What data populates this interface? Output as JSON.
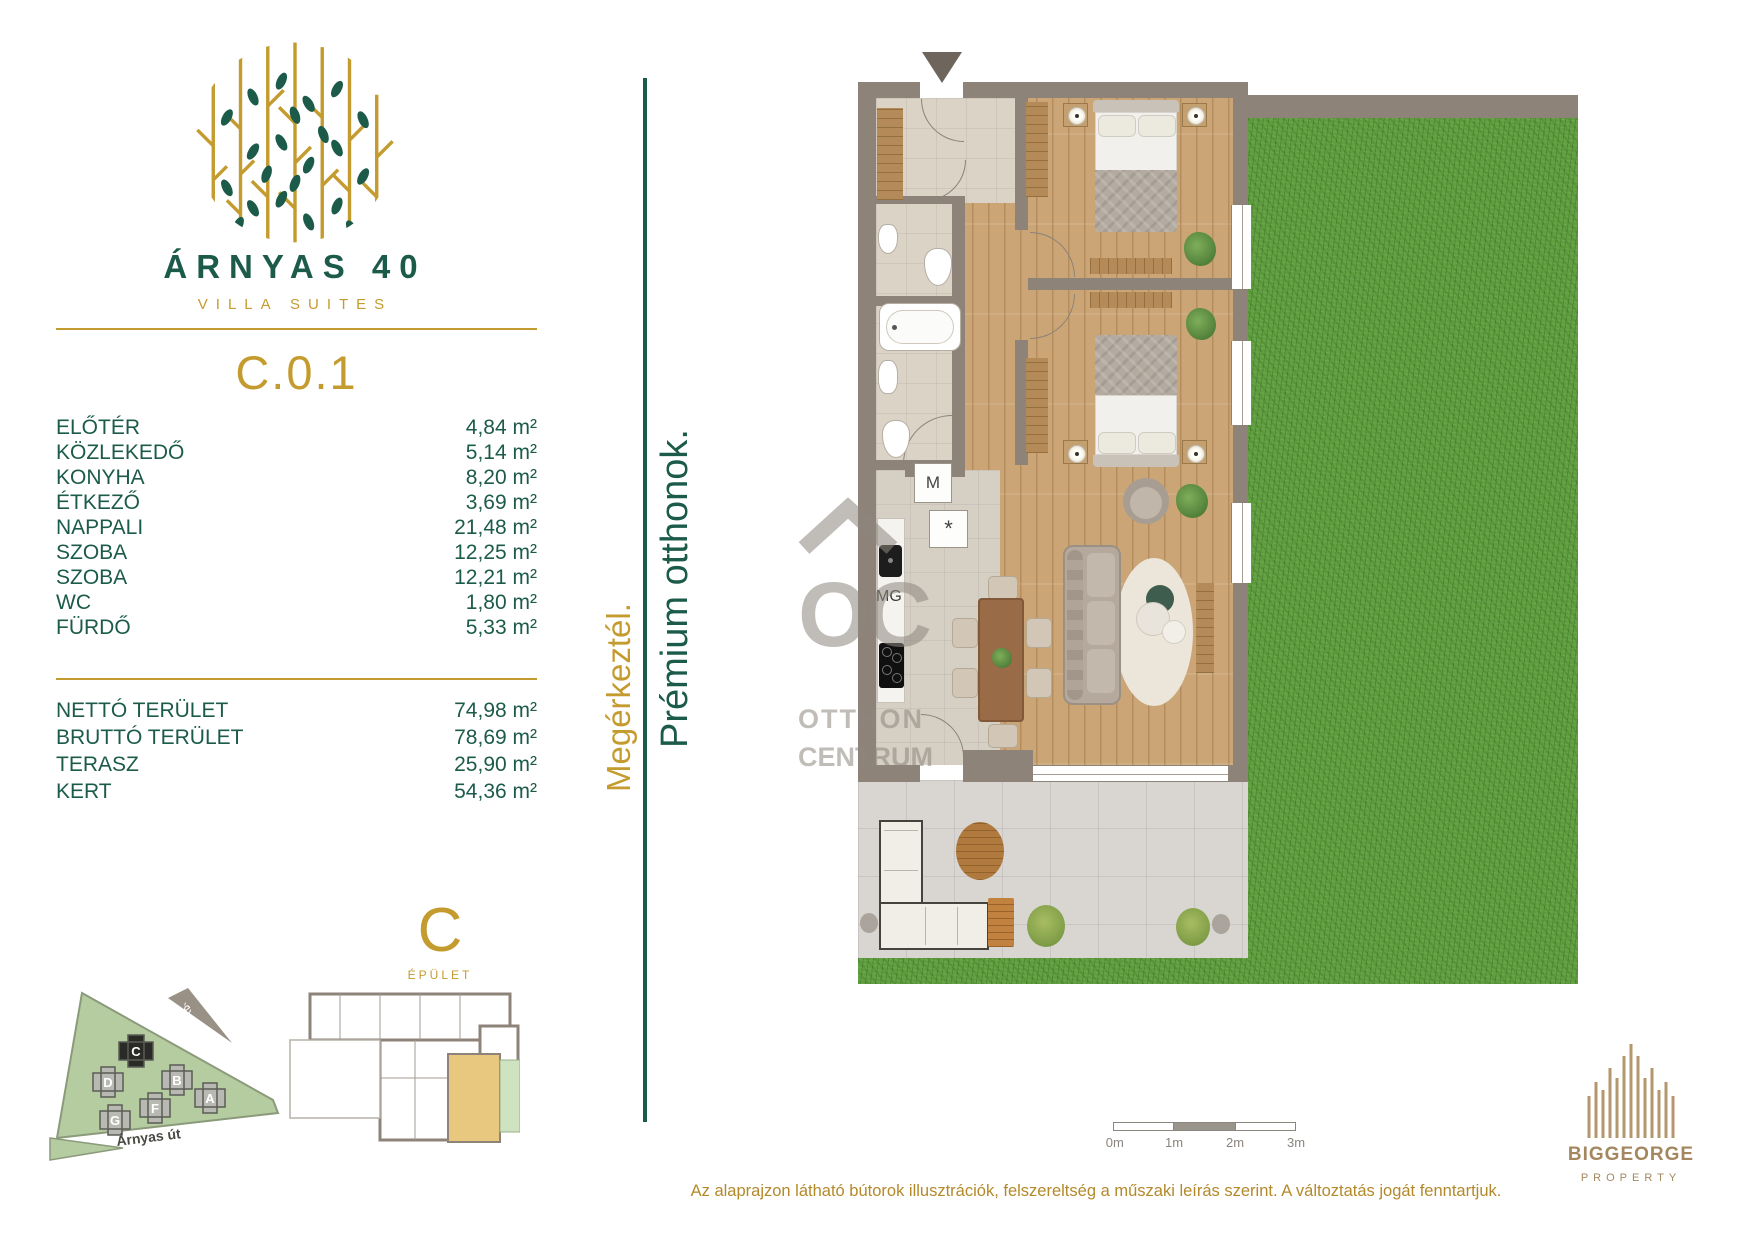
{
  "brand": {
    "title": "ÁRNYAS 40",
    "subtitle": "VILLA SUITES"
  },
  "unit": {
    "code": "C.0.1"
  },
  "rooms": [
    {
      "name": "ELŐTÉR",
      "area": "4,84 m²"
    },
    {
      "name": "KÖZLEKEDŐ",
      "area": "5,14 m²"
    },
    {
      "name": "KONYHA",
      "area": "8,20 m²"
    },
    {
      "name": "ÉTKEZŐ",
      "area": "3,69 m²"
    },
    {
      "name": "NAPPALI",
      "area": "21,48 m²"
    },
    {
      "name": "SZOBA",
      "area": "12,25 m²"
    },
    {
      "name": "SZOBA",
      "area": "12,21 m²"
    },
    {
      "name": "WC",
      "area": "1,80 m²"
    },
    {
      "name": "FÜRDŐ",
      "area": "5,33 m²"
    }
  ],
  "totals": [
    {
      "name": "NETTÓ TERÜLET",
      "area": "74,98 m²"
    },
    {
      "name": "BRUTTÓ TERÜLET",
      "area": "78,69 m²"
    },
    {
      "name": "TERASZ",
      "area": "25,90 m²"
    },
    {
      "name": "KERT",
      "area": "54,36 m²"
    }
  ],
  "taglines": {
    "gold": "Megérkeztél.",
    "green": "Prémium otthonok."
  },
  "plan_labels": {
    "washer": "M",
    "cooler": "*",
    "dishwasher": "MG"
  },
  "watermark": {
    "initials": "OC",
    "line1": "OTTHON",
    "line2": "CENTRUM"
  },
  "site": {
    "street": "Árnyas út",
    "compass": "é",
    "buildings": [
      "C",
      "D",
      "B",
      "A",
      "F",
      "G"
    ]
  },
  "building": {
    "letter": "C",
    "label": "ÉPÜLET"
  },
  "scale": {
    "labels": [
      "0m",
      "1m",
      "2m",
      "3m"
    ]
  },
  "disclaimer": "Az alaprajzon látható bútorok illusztrációk, felszereltség a műszaki leírás szerint. A változtatás jogát fenntartjuk.",
  "publisher": {
    "name": "BIGGEORGE",
    "division": "PROPERTY"
  },
  "colors": {
    "green": "#1c5b4a",
    "gold": "#c49b2e",
    "wall": "#8d8379",
    "bronze": "#a4875e"
  }
}
